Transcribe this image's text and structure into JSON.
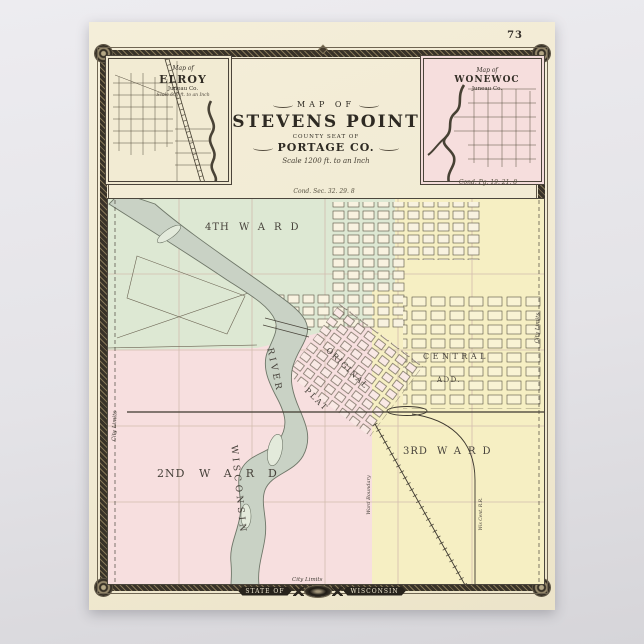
{
  "page": {
    "number": "73"
  },
  "title_block": {
    "line1": "MAP OF",
    "line2": "STEVENS POINT",
    "line3": "COUNTY SEAT OF",
    "line4": "PORTAGE CO.",
    "scale": "Scale 1200 ft. to an Inch"
  },
  "insets": {
    "elroy": {
      "prefix": "Map of",
      "name": "ELROY",
      "county": "Juneau Co.",
      "scale": "Scale 600 ft. to an Inch"
    },
    "wonewoc": {
      "prefix": "Map of",
      "name": "WONEWOC",
      "county": "Juneau Co."
    }
  },
  "captions": {
    "cond_sec": "Cond. Sec. 32. 29. 8",
    "cond_pg": "Cond. Pg. 19. 21. 8"
  },
  "map": {
    "labels": {
      "ward4_num": "4TH",
      "ward4_word": "WARD",
      "ward2_num": "2ND",
      "ward2_word": "WARD",
      "ward3_num": "3RD",
      "ward3_word": "WARD",
      "central": "CENTRAL",
      "central_add": "ADD.",
      "original": "ORIGINAL",
      "plat": "PLAT",
      "river_word1": "WISCONSIN",
      "river_word2": "RIVER",
      "city_limits_left": "City Limits",
      "city_limits_right": "City Limits",
      "city_limits_bottom": "City Limits",
      "ward_boundary": "Ward Boundary",
      "railroad_vertical": "Wis Cent. R.R."
    },
    "colors": {
      "green": "#dde8d3",
      "pink": "#f7dfdf",
      "yellow": "#f6efc3",
      "river": "#c9d2c5",
      "line": "#4b463c",
      "paper": "#f2ebd4"
    }
  },
  "banner": {
    "left": "STATE OF",
    "right": "WISCONSIN"
  }
}
